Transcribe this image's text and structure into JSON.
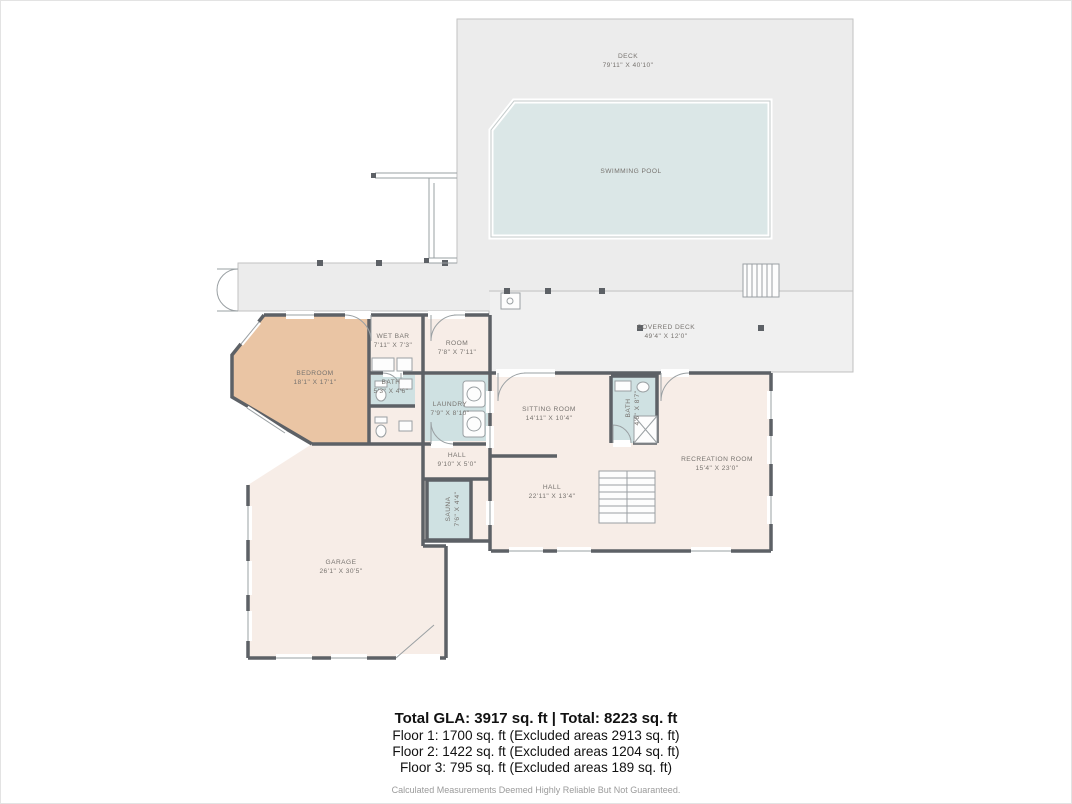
{
  "title": "Floor plan - Floor 1",
  "colors": {
    "deck_fill": "#ececec",
    "covered_deck_fill": "#f0f0f0",
    "deck_stroke": "#c2c2c2",
    "pool_fill": "#dbe7e7",
    "pool_stroke": "#c3caca",
    "room_fill": "#f7ede7",
    "accent_room_fill": "#eac5a4",
    "wet_room_fill": "#cfe1e2",
    "wall": "#5d6166",
    "thin_line": "#9aa0a3",
    "label_text": "#77736f",
    "footer_text": "#111111",
    "disclaimer_text": "#9b9b9b"
  },
  "rooms": [
    {
      "id": "deck",
      "name": "DECK",
      "dims": "79'11\" X 40'10\"",
      "x": 627,
      "y": 57,
      "rotate": 0
    },
    {
      "id": "swimming-pool",
      "name": "SWIMMING POOL",
      "dims": "",
      "x": 630,
      "y": 172,
      "rotate": 0
    },
    {
      "id": "covered-deck",
      "name": "COVERED DECK",
      "dims": "49'4\" X 12'0\"",
      "x": 665,
      "y": 328,
      "rotate": 0
    },
    {
      "id": "wet-bar",
      "name": "WET BAR",
      "dims": "7'11\" X 7'3\"",
      "x": 392,
      "y": 337,
      "rotate": 0
    },
    {
      "id": "room",
      "name": "ROOM",
      "dims": "7'8\" X 7'11\"",
      "x": 456,
      "y": 344,
      "rotate": 0
    },
    {
      "id": "bedroom",
      "name": "BEDROOM",
      "dims": "18'1\" X 17'1\"",
      "x": 314,
      "y": 374,
      "rotate": 0
    },
    {
      "id": "bath-1",
      "name": "BATH",
      "dims": "5'3\" X 4'6\"",
      "x": 390,
      "y": 383,
      "rotate": 0
    },
    {
      "id": "laundry",
      "name": "LAUNDRY",
      "dims": "7'9\" X 8'10\"",
      "x": 449,
      "y": 405,
      "rotate": 0
    },
    {
      "id": "sitting-room",
      "name": "SITTING ROOM",
      "dims": "14'11\" X 10'4\"",
      "x": 548,
      "y": 410,
      "rotate": 0
    },
    {
      "id": "bath-2",
      "name": "BATH",
      "dims": "4'6\" X 8'7\"",
      "x": 629,
      "y": 407,
      "rotate": -90
    },
    {
      "id": "hall-1",
      "name": "HALL",
      "dims": "9'10\" X 5'0\"",
      "x": 456,
      "y": 456,
      "rotate": 0
    },
    {
      "id": "sauna",
      "name": "SAUNA",
      "dims": "7'6\" X 4'4\"",
      "x": 449,
      "y": 508,
      "rotate": -90
    },
    {
      "id": "hall-2",
      "name": "HALL",
      "dims": "22'11\" X 13'4\"",
      "x": 551,
      "y": 488,
      "rotate": 0
    },
    {
      "id": "recreation-room",
      "name": "RECREATION ROOM",
      "dims": "15'4\" X 23'0\"",
      "x": 716,
      "y": 460,
      "rotate": 0
    },
    {
      "id": "garage",
      "name": "GARAGE",
      "dims": "26'1\" X 30'5\"",
      "x": 340,
      "y": 563,
      "rotate": 0
    }
  ],
  "footer": {
    "total_line": "Total GLA: 3917 sq. ft | Total: 8223 sq. ft",
    "floor_lines": [
      "Floor 1: 1700 sq. ft (Excluded areas 2913 sq. ft)",
      "Floor 2: 1422 sq. ft (Excluded areas 1204 sq. ft)",
      "Floor 3: 795 sq. ft (Excluded areas 189 sq. ft)"
    ],
    "disclaimer": "Calculated Measurements Deemed Highly Reliable But Not Guaranteed."
  }
}
